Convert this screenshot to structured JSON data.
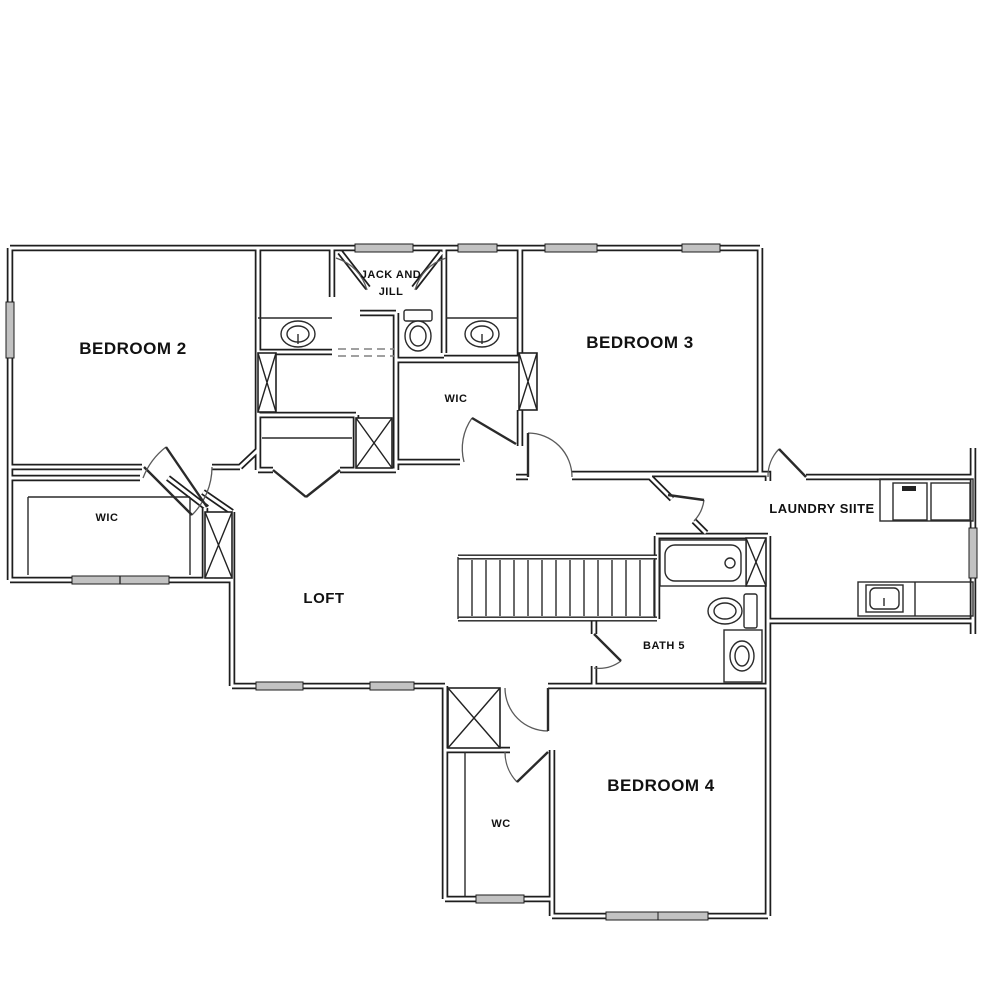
{
  "plan": {
    "rooms": {
      "bedroom2": "BEDROOM 2",
      "jack_and_jill_line1": "JACK AND",
      "jack_and_jill_line2": "JILL",
      "bedroom3": "BEDROOM 3",
      "wic_center": "WIC",
      "wic_left": "WIC",
      "loft": "LOFT",
      "laundry": "LAUNDRY SIITE",
      "bath5": "BATH 5",
      "bedroom4": "BEDROOM 4",
      "wc": "WC"
    },
    "colors": {
      "wall": "#1e1e1e",
      "window_fill": "#c2c2c2",
      "background": "#ffffff",
      "label": "#111111"
    }
  }
}
